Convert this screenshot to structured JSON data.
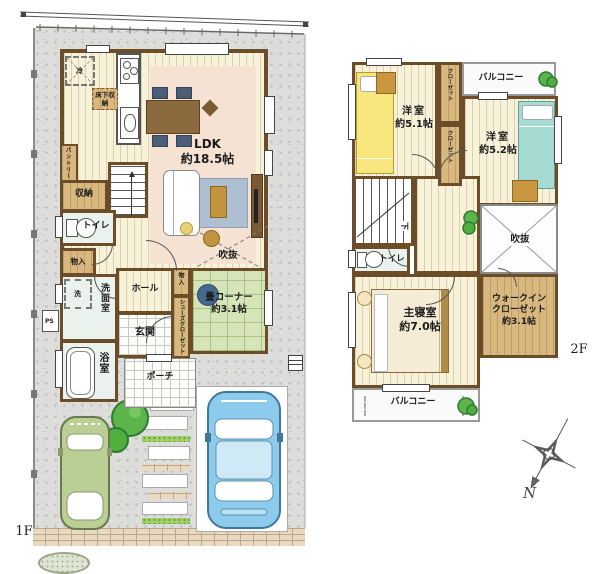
{
  "f1": {
    "floor_label": "1F",
    "ldk_name": "LDK",
    "ldk_size": "約18.5帖",
    "void_label": "吹抜",
    "fridge": "冷",
    "floor_storage": "床下収納",
    "pantry": "パントリー",
    "storage": "収納",
    "toilet": "トイレ",
    "closet_left": "物入",
    "closet_hall": "物入",
    "washer": "洗",
    "ps": "PS",
    "washroom": "洗面室",
    "bath": "浴室",
    "hall": "ホール",
    "genkan": "玄関",
    "shoes_closet": "シューズクローゼット",
    "porch": "ポーチ",
    "tatami_name": "畳コーナー",
    "tatami_size": "約3.1帖"
  },
  "f2": {
    "floor_label": "2F",
    "bed1_name": "洋室",
    "bed1_size": "約5.1帖",
    "bed2_name": "洋室",
    "bed2_size": "約5.2帖",
    "closet1": "クローゼット",
    "closet2": "クローゼット",
    "balcony_top": "バルコニー",
    "balcony_bottom": "バルコニー",
    "toilet": "トイレ",
    "void_label": "吹抜",
    "stairs_down": "下",
    "master_name": "主寝室",
    "master_size": "約7.0帖",
    "wic_line1": "ウォークイン",
    "wic_line2": "クローゼット",
    "wic_size": "約3.1帖"
  },
  "compass": {
    "north": "N"
  },
  "colors": {
    "wall": "#6d4d27",
    "floor": "#f8f2da",
    "tatami": "#d6e5b8",
    "closet": "#d8b87f",
    "rug": "#f6e2d2",
    "car_green": "#b9cf93",
    "car_blue": "#8ccbeb"
  }
}
